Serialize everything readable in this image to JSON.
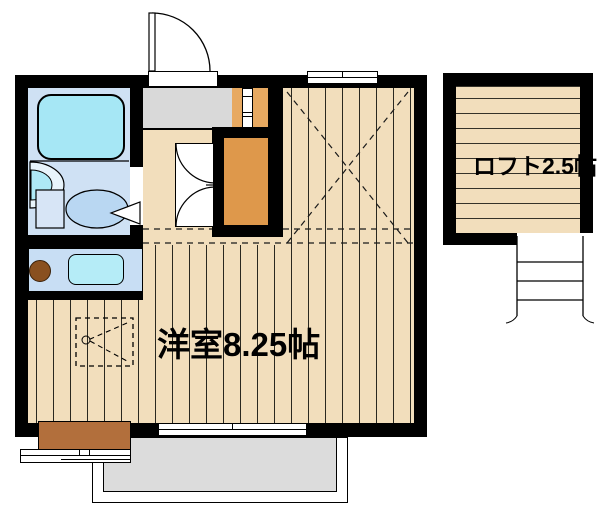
{
  "plan": {
    "type": "apartment-floorplan",
    "main_room": {
      "label": "洋室8.25帖"
    },
    "loft": {
      "label": "ロフト2.5帖"
    },
    "features": [
      "entry-door",
      "genkan-entry",
      "bathroom",
      "bathtub",
      "washbasin",
      "toilet",
      "kitchen-counter",
      "gas-burner",
      "kitchen-sink",
      "closet",
      "double-doors",
      "storage-unit",
      "loft",
      "loft-ladder",
      "ladder-icon",
      "balcony",
      "sliding-window",
      "top-window",
      "bay-window",
      "step-storage"
    ],
    "colors": {
      "wall": "#000000",
      "wood_floor": "#f2debc",
      "bathroom_floor": "#cfe1f4",
      "bathtub": "#a6e7f5",
      "kitchen_counter": "#c8def4",
      "kitchen_sink": "#b5ecf7",
      "closet": "#de984b",
      "storage_unit": "#e7a961",
      "genkan": "#d9d9d9",
      "balcony": "#dcdcdc",
      "step": "#b26f3c",
      "burner": "#89501f"
    }
  }
}
